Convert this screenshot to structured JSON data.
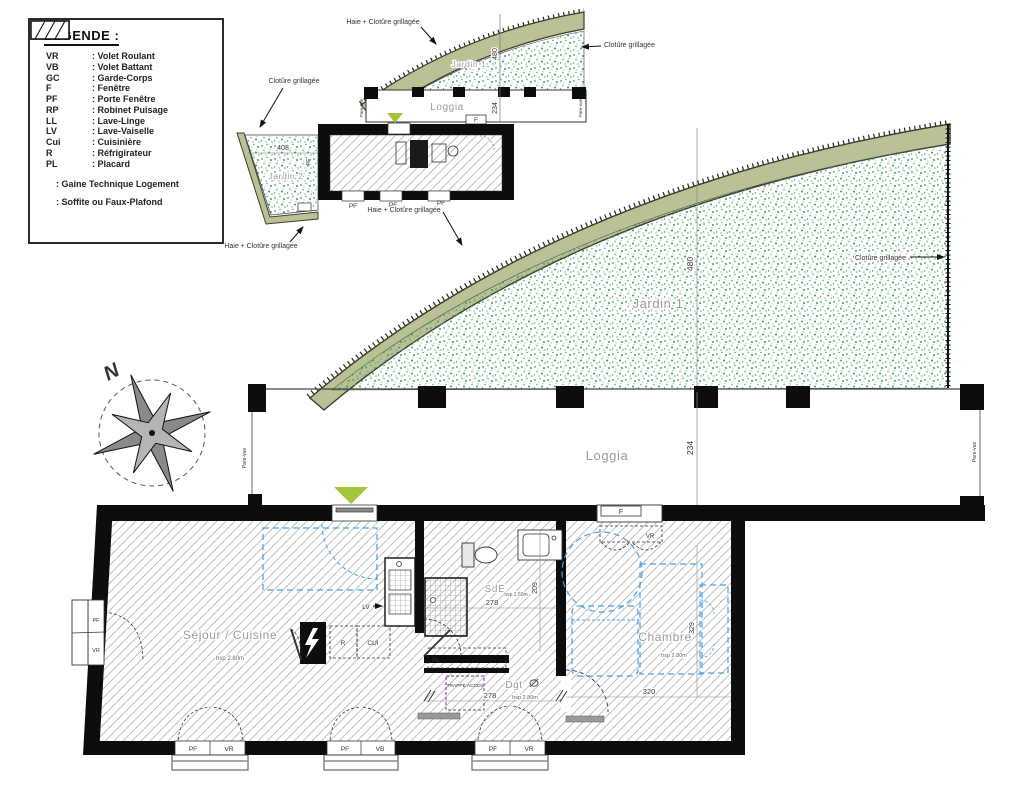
{
  "legend": {
    "title": "LEGENDE :",
    "items": [
      {
        "abbr": "VR",
        "label": ": Volet Roulant"
      },
      {
        "abbr": "VB",
        "label": ": Volet Battant"
      },
      {
        "abbr": "GC",
        "label": ": Garde-Corps"
      },
      {
        "abbr": "F",
        "label": ": Fenêtre"
      },
      {
        "abbr": "PF",
        "label": ": Porte Fenêtre"
      },
      {
        "abbr": "RP",
        "label": ": Robinet Puisage"
      },
      {
        "abbr": "LL",
        "label": ": Lave-Linge"
      },
      {
        "abbr": "LV",
        "label": ": Lave-Vaiselle"
      },
      {
        "abbr": "Cui",
        "label": ": Cuisinière"
      },
      {
        "abbr": "R",
        "label": ": Réfrigirateur"
      },
      {
        "abbr": "PL",
        "label": ": Placard"
      }
    ],
    "symbols": [
      {
        "name": "gaine-technique",
        "label": ": Gaine Technique Logement"
      },
      {
        "name": "soffite",
        "label": ": Soffite ou Faux-Plafond"
      }
    ]
  },
  "compass": {
    "north": "N"
  },
  "mini_plan": {
    "jardin1": "Jardin 1",
    "jardin2": "Jardin 2",
    "loggia": "Loggia",
    "dim_jardin": "480",
    "dim_loggia": "234",
    "dim_jardin2": "408",
    "label_f": "F",
    "label_pf": "PF",
    "pare_vue": "Pare-vue",
    "haie_top": "Haie + Clotûre grillagée",
    "cloture_right": "Clotûre grillagée",
    "cloture_left": "Clotûre grillagée",
    "haie_bottom_left": "Haie + Clotûre grillagée",
    "haie_bottom": "Haie + Clotûre grillagée"
  },
  "main_plan": {
    "jardin1": "Jardin 1",
    "loggia": "Loggia",
    "dim_jardin": "480",
    "dim_loggia": "234",
    "cloture_right": "Clotûre grillagée",
    "pare_vue": "Pare-vue"
  },
  "apartment": {
    "sejour": {
      "name": "Séjour / Cuisine",
      "hsp": "hsp 2.80m"
    },
    "sde": {
      "name": "SdE",
      "hsp": "hsp 2.50m",
      "dim_w": "278",
      "dim_h": "209"
    },
    "dgt": {
      "name": "Dgt",
      "hsp": "hsp 2.80m",
      "dim_w": "278"
    },
    "chambre": {
      "name": "Chambre",
      "hsp": "hsp 2.80m",
      "dim_w": "320",
      "dim_h": "329"
    },
    "trappe": "TRAPPE ACCES",
    "labels": {
      "pf": "PF",
      "vr": "VR",
      "vb": "VB",
      "f": "F",
      "pl": "PL",
      "r": "R",
      "cui": "CUI",
      "lv": "LV"
    }
  },
  "colors": {
    "hedge_band": "#b8c294",
    "garden_speckle": "#3a9e63",
    "wall_black": "#0d0d0d",
    "furniture_blue": "#4aa0e8",
    "entrance_green": "#a3c53a",
    "trappe_purple": "#8a2d9c"
  }
}
